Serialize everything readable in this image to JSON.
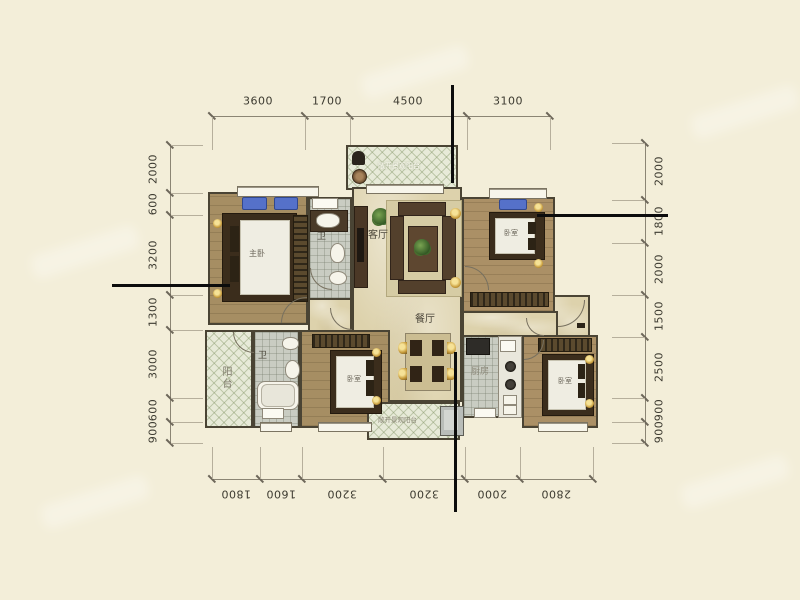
{
  "dims": {
    "top": [
      "3600",
      "1700",
      "4500",
      "3100"
    ],
    "bottom": [
      "1800",
      "1600",
      "3200",
      "3200",
      "2000",
      "2800"
    ],
    "left": [
      "2000",
      "600",
      "3200",
      "1300",
      "3000",
      "600",
      "900"
    ],
    "right": [
      "2000",
      "1800",
      "2000",
      "1500",
      "2500",
      "900",
      "900"
    ]
  },
  "rooms": {
    "master": "主卧",
    "bedroom_top_right": "卧室",
    "bedroom_bottom_left": "卧室",
    "bedroom_bottom_right": "卧室",
    "living": "客厅",
    "dining": "餐厅",
    "kitchen": "厨房",
    "bath_top": "卫",
    "bath_bottom": "卫",
    "side_balcony": "阳台",
    "top_balcony": "敞开景观阳台",
    "bottom_balcony": "敞开景观阳台"
  },
  "colors": {
    "background": "#f3eed9",
    "wall": "#4a4434",
    "wood_floor": "#a68e63",
    "marble_floor": "#ddd2ac",
    "tile_floor": "#c9ccc2",
    "lattice_balcony": "#e7ead8",
    "accent_blue": "#5571c9",
    "gold": "#c79b3a",
    "callout_line": "#0c0c0c"
  }
}
